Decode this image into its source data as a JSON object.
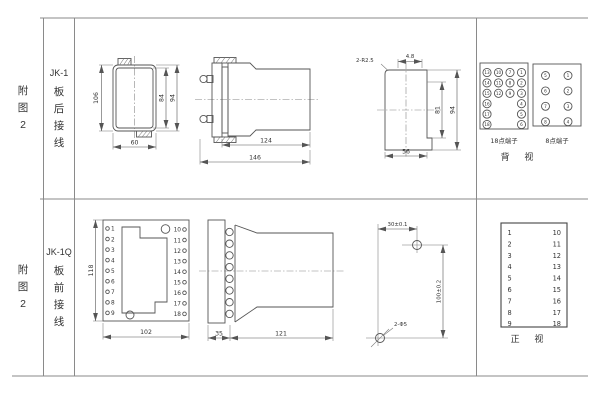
{
  "sheet": {
    "row1": {
      "fig": [
        "附",
        "图",
        "2"
      ],
      "model": "JK-1",
      "wiring": [
        "板",
        "后",
        "接",
        "线"
      ],
      "front_view": {
        "height": "106",
        "inner_height": "84",
        "outer_height": "94",
        "width": "60"
      },
      "side_view": {
        "body_length": "124",
        "total_length": "146"
      },
      "cutout_view": {
        "corner_radius": "2-R2.5",
        "top_offset": "4.8",
        "inner_height": "81",
        "outer_height": "94",
        "width": "56"
      },
      "terminals_18": {
        "label": "18点端子",
        "columns": [
          [
            13,
            14,
            15,
            16,
            17,
            18
          ],
          [
            10,
            11,
            12
          ],
          [
            7,
            8,
            9
          ],
          [
            1,
            2,
            3,
            4,
            5,
            6
          ]
        ]
      },
      "terminals_8": {
        "label": "8点端子",
        "columns": [
          [
            5,
            6,
            7,
            8
          ],
          [
            1,
            2,
            3,
            4
          ]
        ]
      },
      "view_label": "背 视"
    },
    "row2": {
      "fig": [
        "附",
        "图",
        "2"
      ],
      "model": "JK-1Q",
      "wiring": [
        "板",
        "前",
        "接",
        "线"
      ],
      "plate_view": {
        "height": "118",
        "width": "102",
        "left_terminals": [
          1,
          2,
          3,
          4,
          5,
          6,
          7,
          8,
          9
        ],
        "right_terminals": [
          10,
          11,
          12,
          13,
          14,
          15,
          16,
          17,
          18
        ]
      },
      "side_view": {
        "plate_depth": "35",
        "body_length": "121"
      },
      "drill_view": {
        "hole_spacing_x": "30±0.1",
        "hole_spacing_y": "100±0.2",
        "holes": "2-Φ5"
      },
      "terminal_list": {
        "left": [
          1,
          2,
          3,
          4,
          5,
          6,
          7,
          8,
          9
        ],
        "right": [
          10,
          11,
          12,
          13,
          14,
          15,
          16,
          17,
          18
        ]
      },
      "view_label": "正 视"
    }
  }
}
